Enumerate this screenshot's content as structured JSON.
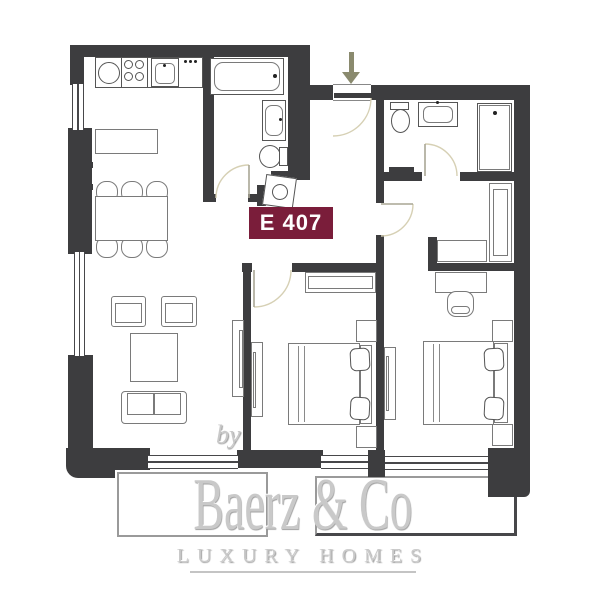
{
  "unit": {
    "label": "E 407"
  },
  "watermark": {
    "prefix": "by",
    "brand": "Baerz & Co",
    "tagline": "LUXURY HOMES"
  },
  "colors": {
    "wall": "#3d3d3f",
    "badge_bg": "#7a1d3a",
    "badge_text": "#ffffff",
    "door_arc": "#d6d0b4",
    "entry_arrow": "#8a8a6e",
    "watermark": "#c9c9c9",
    "furniture_line": "#7a7a7a",
    "fixture_line": "#555555",
    "balcony_line": "#9a9a9a"
  }
}
